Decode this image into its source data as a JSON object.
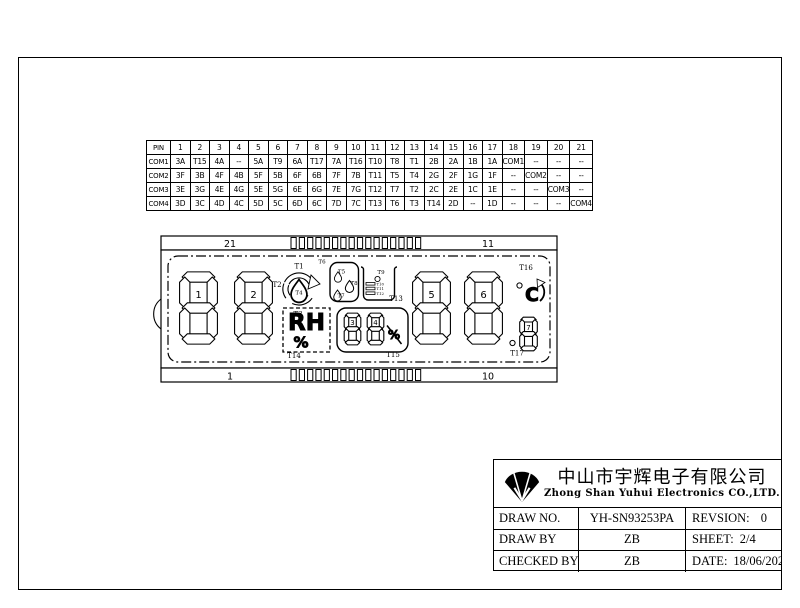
{
  "sheet": {
    "company": {
      "name_cn": "中山市宇辉电子有限公司",
      "name_en": "Zhong Shan Yuhui Electronics CO.,LTD."
    },
    "title_block": {
      "draw_no_label": "DRAW NO.",
      "draw_no": "YH-SN93253PA",
      "revision_label": "REVSION:",
      "revision": "0",
      "draw_by_label": "DRAW BY",
      "draw_by": "ZB",
      "sheet_label": "SHEET:",
      "sheet": "2/4",
      "checked_by_label": "CHECKED BY",
      "checked_by": "ZB",
      "date_label": "DATE:",
      "date": "18/06/2021"
    }
  },
  "pin_table": {
    "header": [
      "PIN",
      "1",
      "2",
      "3",
      "4",
      "5",
      "6",
      "7",
      "8",
      "9",
      "10",
      "11",
      "12",
      "13",
      "14",
      "15",
      "16",
      "17",
      "18",
      "19",
      "20",
      "21"
    ],
    "rows": [
      {
        "label": "COM1",
        "values": [
          "3A",
          "T15",
          "4A",
          "--",
          "5A",
          "T9",
          "6A",
          "T17",
          "7A",
          "T16",
          "T10",
          "T8",
          "T1",
          "2B",
          "2A",
          "1B",
          "1A",
          "COM1",
          "--",
          "--",
          "--"
        ]
      },
      {
        "label": "COM2",
        "values": [
          "3F",
          "3B",
          "4F",
          "4B",
          "5F",
          "5B",
          "6F",
          "6B",
          "7F",
          "7B",
          "T11",
          "T5",
          "T4",
          "2G",
          "2F",
          "1G",
          "1F",
          "--",
          "COM2",
          "--",
          "--"
        ]
      },
      {
        "label": "COM3",
        "values": [
          "3E",
          "3G",
          "4E",
          "4G",
          "5E",
          "5G",
          "6E",
          "6G",
          "7E",
          "7G",
          "T12",
          "T7",
          "T2",
          "2C",
          "2E",
          "1C",
          "1E",
          "--",
          "--",
          "COM3",
          "--"
        ]
      },
      {
        "label": "COM4",
        "values": [
          "3D",
          "3C",
          "4D",
          "4C",
          "5D",
          "5C",
          "6D",
          "6C",
          "7D",
          "7C",
          "T13",
          "T6",
          "T3",
          "T14",
          "2D",
          "--",
          "1D",
          "--",
          "--",
          "--",
          "COM4"
        ]
      }
    ]
  },
  "lcd": {
    "corners": {
      "top_left": "21",
      "top_right": "11",
      "bottom_left": "1",
      "bottom_right": "10"
    },
    "digits": {
      "d1": "1",
      "d2": "2",
      "d3": "3",
      "d4": "4",
      "d5": "5",
      "d6": "6",
      "d7": "7"
    },
    "tags": {
      "t1": "T1",
      "t2": "T2",
      "t3": "T3",
      "t4": "T4",
      "t5": "T5",
      "t6": "T6",
      "t7": "T7",
      "t8": "T8",
      "t9": "T9",
      "t10": "T10",
      "t11": "T11",
      "t12": "T12",
      "t13": "T13",
      "t14": "T14",
      "t15": "T15",
      "t16": "T16",
      "t17": "T17"
    },
    "texts": {
      "rh": "RH",
      "percent": "%",
      "percent_off": "%",
      "celsius": "C"
    }
  }
}
